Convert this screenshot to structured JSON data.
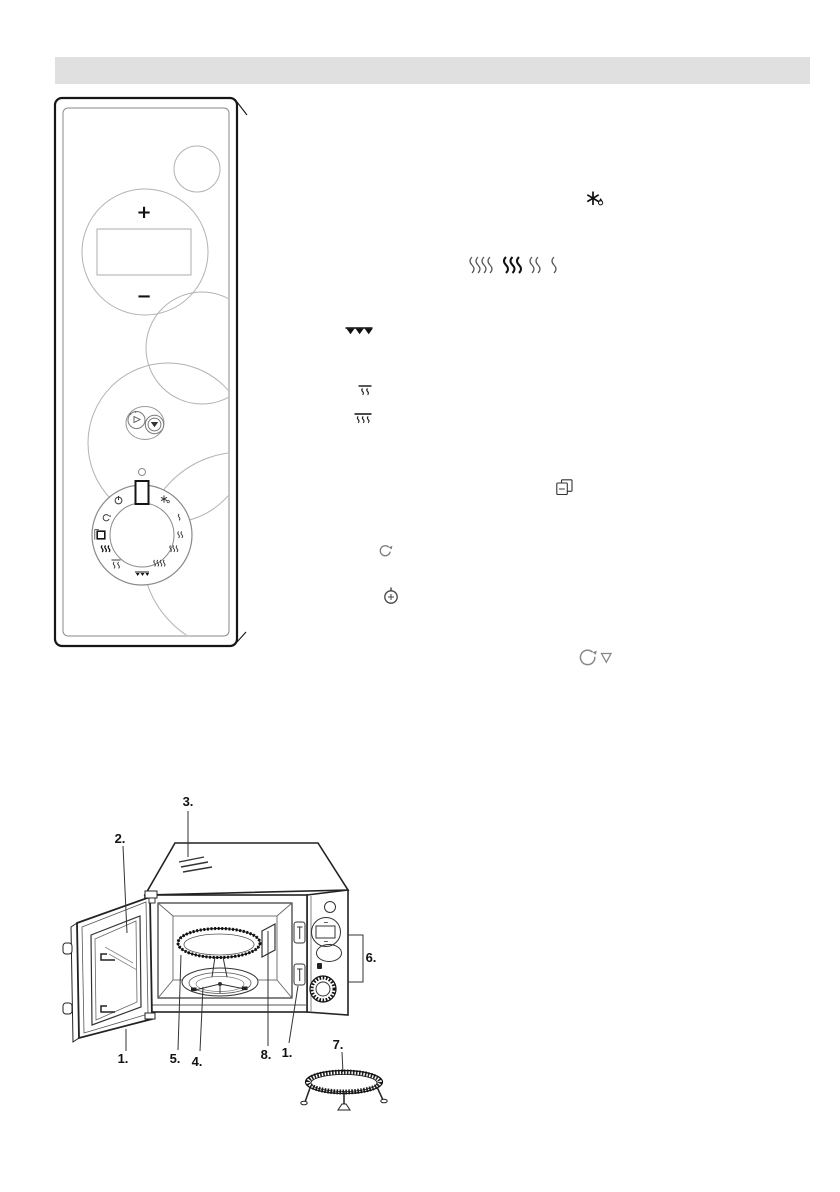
{
  "document": {
    "type": "scanned appliance manual page",
    "header_bar_text": ""
  },
  "colors": {
    "header_bar": "#e0e0e0",
    "line": "#1a1a1a",
    "faint_line": "#9a9a9a"
  },
  "control_panel_figure": {
    "plus_button_label": "+",
    "minus_button_label": "−",
    "button_icons": [
      "timer-button-icon",
      "bell-button-icon"
    ],
    "dial_icons": [
      "power-icon",
      "turntable-rotate-icon",
      "stop-square-icon",
      "three-waves-bold-icon",
      "line-two-waves-icon",
      "grill-icon",
      "four-waves-icon",
      "three-waves-icon",
      "two-waves-icon",
      "one-wave-icon",
      "defrost-icon"
    ]
  },
  "inline_mode_icons": {
    "defrost": "defrost-icon",
    "power_levels": [
      "four-waves-icon",
      "three-waves-bold-icon",
      "two-waves-icon",
      "one-wave-icon"
    ],
    "grill": "grill-triangles-icon",
    "grill_micro_combo_small": "line-two-waves-icon",
    "grill_micro_combo_large": "line-three-waves-icon",
    "memory": "stacked-pages-icon",
    "turntable": "rotate-arrow-icon",
    "timer": "clock-plus-icon",
    "turntable_stop": "rotate-arrow-triangle-icon"
  },
  "oven_figure": {
    "labels": {
      "door_bottom": "1.",
      "door_window": "2.",
      "vents": "3.",
      "roller_ring": "4.",
      "glass_tray": "5.",
      "control_panel": "6.",
      "grill_rack": "7.",
      "waveguide_cover": "8.",
      "door_latch": "1."
    }
  }
}
